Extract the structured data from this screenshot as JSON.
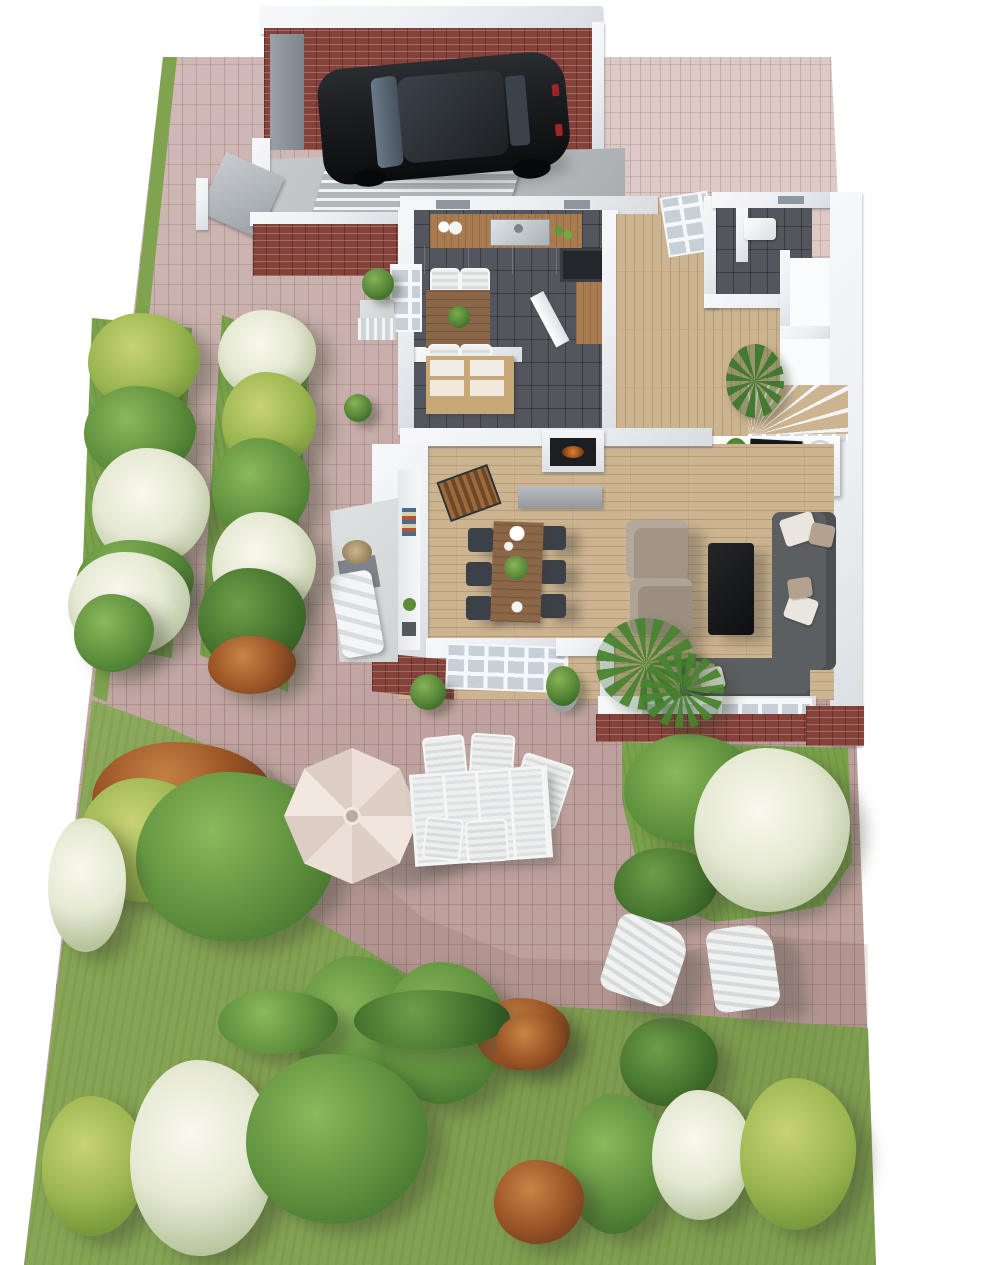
{
  "meta": {
    "type": "3d-floor-plan-rendering",
    "view": "isometric-top-down",
    "content": "single-family house ground floor cutaway with garden, driveway, car, patio and garden furniture"
  },
  "palette": {
    "bg": "#ffffff",
    "paving": "#c9aeab",
    "driveway": "#ddcac6",
    "lawn": "#89a757",
    "bedgrass": "#7aa24c",
    "wall": "#eef1f4",
    "wallShade": "#d9dde2",
    "brick": "#85423a",
    "woodFloor": "#cdb491",
    "tileDark": "#53575d",
    "counterWood": "#a87c50",
    "tableWood": "#8b6748",
    "chairDark": "#3c4148",
    "sofaGray": "#5b5f61",
    "armchairTaupe": "#a39586",
    "black": "#141618",
    "carBody": "#1b1d20",
    "glass": "#5d6b79",
    "umbrella": "#ebdfd7",
    "umbrella2": "#ddcfc6",
    "outdoorWhite": "#edefef",
    "concrete": "#b9bcbf",
    "terrace": "#cfd3d4",
    "fire": "#e08030",
    "plantGreen": "#4f8434",
    "pillowWhite": "#eae6dd",
    "pillowTaupe": "#b5a28e"
  },
  "rooms": [
    "garage",
    "carport-storage",
    "kitchen",
    "utility-room",
    "entry-hall",
    "wc",
    "closet",
    "stairs",
    "living-room",
    "dining-area",
    "terrace",
    "patio",
    "driveway",
    "lawn",
    "garden-beds"
  ],
  "furniture": [
    "black-car",
    "kitchen-counter-with-sink",
    "cooktop",
    "kitchen-table-with-chairs",
    "basket-shelf-unit",
    "dining-table-with-six-chairs",
    "fireplace",
    "firewood-rack",
    "two-armchairs",
    "black-coffee-table",
    "corner-sofa",
    "tv-sideboard",
    "sun-lounger",
    "patio-umbrella",
    "outdoor-dining-table",
    "outdoor-chairs",
    "two-adirondack-chairs"
  ],
  "vegetation": [
    {
      "x": 88,
      "y": 313,
      "w": 112,
      "h": 96,
      "kind": "yellowgreen"
    },
    {
      "x": 84,
      "y": 386,
      "w": 112,
      "h": 92,
      "kind": "green"
    },
    {
      "x": 92,
      "y": 448,
      "w": 118,
      "h": 118,
      "kind": "blossom"
    },
    {
      "x": 76,
      "y": 540,
      "w": 118,
      "h": 84,
      "kind": "green"
    },
    {
      "x": 68,
      "y": 552,
      "w": 122,
      "h": 104,
      "kind": "blossom"
    },
    {
      "x": 74,
      "y": 594,
      "w": 80,
      "h": 78,
      "kind": "green"
    },
    {
      "x": 218,
      "y": 310,
      "w": 98,
      "h": 88,
      "kind": "blossom"
    },
    {
      "x": 222,
      "y": 372,
      "w": 94,
      "h": 98,
      "kind": "yellowgreen"
    },
    {
      "x": 212,
      "y": 438,
      "w": 98,
      "h": 102,
      "kind": "green"
    },
    {
      "x": 212,
      "y": 512,
      "w": 104,
      "h": 108,
      "kind": "blossom"
    },
    {
      "x": 198,
      "y": 568,
      "w": 108,
      "h": 102,
      "kind": "darkgreen"
    },
    {
      "x": 208,
      "y": 636,
      "w": 88,
      "h": 58,
      "kind": "red"
    },
    {
      "x": 92,
      "y": 742,
      "w": 180,
      "h": 112,
      "kind": "red"
    },
    {
      "x": 78,
      "y": 778,
      "w": 134,
      "h": 124,
      "kind": "yellowgreen"
    },
    {
      "x": 136,
      "y": 772,
      "w": 200,
      "h": 170,
      "kind": "green"
    },
    {
      "x": 48,
      "y": 818,
      "w": 78,
      "h": 134,
      "kind": "blossom"
    },
    {
      "x": 296,
      "y": 956,
      "w": 124,
      "h": 144,
      "kind": "green"
    },
    {
      "x": 382,
      "y": 962,
      "w": 124,
      "h": 142,
      "kind": "green"
    },
    {
      "x": 476,
      "y": 998,
      "w": 94,
      "h": 72,
      "kind": "red"
    },
    {
      "x": 620,
      "y": 1018,
      "w": 98,
      "h": 88,
      "kind": "darkgreen"
    },
    {
      "x": 624,
      "y": 734,
      "w": 134,
      "h": 110,
      "kind": "green"
    },
    {
      "x": 614,
      "y": 848,
      "w": 104,
      "h": 74,
      "kind": "darkgreen"
    },
    {
      "x": 694,
      "y": 748,
      "w": 156,
      "h": 164,
      "kind": "blossom"
    },
    {
      "x": 218,
      "y": 990,
      "w": 120,
      "h": 64,
      "kind": "green"
    },
    {
      "x": 354,
      "y": 990,
      "w": 156,
      "h": 60,
      "kind": "darkgreen"
    },
    {
      "x": 42,
      "y": 1096,
      "w": 104,
      "h": 140,
      "kind": "yellowgreen"
    },
    {
      "x": 130,
      "y": 1060,
      "w": 146,
      "h": 196,
      "kind": "blossom"
    },
    {
      "x": 246,
      "y": 1054,
      "w": 182,
      "h": 170,
      "kind": "green"
    },
    {
      "x": 566,
      "y": 1094,
      "w": 100,
      "h": 140,
      "kind": "green"
    },
    {
      "x": 652,
      "y": 1090,
      "w": 100,
      "h": 130,
      "kind": "blossom"
    },
    {
      "x": 740,
      "y": 1078,
      "w": 116,
      "h": 152,
      "kind": "yellowgreen"
    },
    {
      "x": 494,
      "y": 1160,
      "w": 90,
      "h": 84,
      "kind": "red"
    },
    {
      "x": 496,
      "y": 1014,
      "w": 70,
      "h": 56,
      "kind": "red"
    },
    {
      "x": 362,
      "y": 268,
      "w": 32,
      "h": 32,
      "kind": "boxwood"
    },
    {
      "x": 344,
      "y": 394,
      "w": 28,
      "h": 28,
      "kind": "boxwood"
    },
    {
      "x": 410,
      "y": 674,
      "w": 36,
      "h": 36,
      "kind": "boxwood"
    },
    {
      "x": 546,
      "y": 666,
      "w": 34,
      "h": 40,
      "kind": "boxwoodpot"
    },
    {
      "x": 596,
      "y": 618,
      "w": 100,
      "h": 92,
      "kind": "palm"
    },
    {
      "x": 640,
      "y": 652,
      "w": 84,
      "h": 76,
      "kind": "palm"
    },
    {
      "x": 726,
      "y": 344,
      "w": 58,
      "h": 74,
      "kind": "plant"
    }
  ]
}
